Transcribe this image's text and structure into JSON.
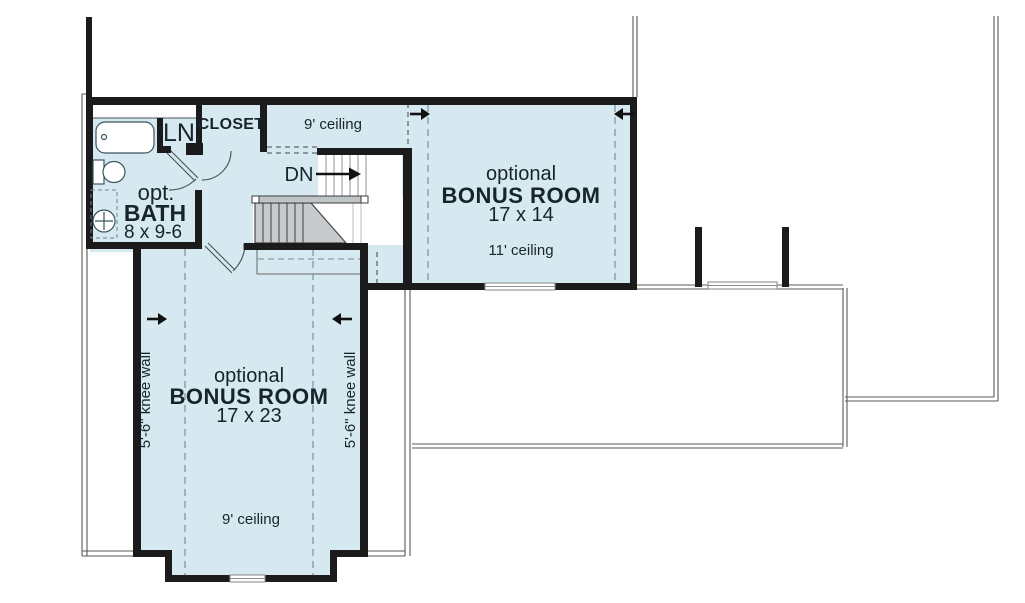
{
  "colors": {
    "room_fill": "#d7e9f0",
    "wall": "#1b1b1b",
    "text": "#17242b",
    "dashed_line": "#859dab",
    "stair_gray": "#c7cbce",
    "roof_line": "#5a5a5a"
  },
  "hall": {
    "ceiling_label": "9' ceiling",
    "closet_label": "CLOSET",
    "linen_label": "LN",
    "down_label": "DN"
  },
  "bath": {
    "prefix": "opt.",
    "name": "BATH",
    "size": "8 x 9-6"
  },
  "bonus_upper": {
    "prefix": "optional",
    "name": "BONUS ROOM",
    "size": "17 x 14",
    "ceiling_label": "11' ceiling"
  },
  "bonus_lower": {
    "prefix": "optional",
    "name": "BONUS ROOM",
    "size": "17 x 23",
    "ceiling_label": "9' ceiling",
    "knee_wall_left": "5'-6\" knee wall",
    "knee_wall_right": "5'-6\" knee wall"
  }
}
